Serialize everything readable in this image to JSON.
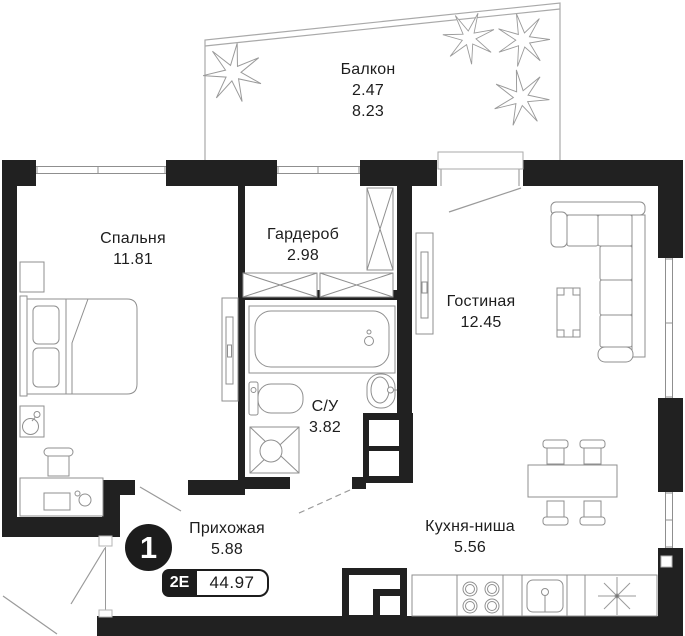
{
  "plan": {
    "badge": {
      "number": "1",
      "layout": "2Е",
      "total_area": "44.97"
    },
    "rooms": {
      "balcony": {
        "name": "Балкон",
        "area": "2.47",
        "area_full": "8.23"
      },
      "bedroom": {
        "name": "Спальня",
        "area": "11.81"
      },
      "wardrobe": {
        "name": "Гардероб",
        "area": "2.98"
      },
      "living": {
        "name": "Гостиная",
        "area": "12.45"
      },
      "bathroom": {
        "name": "С/У",
        "area": "3.82"
      },
      "hallway": {
        "name": "Прихожая",
        "area": "5.88"
      },
      "kitchen": {
        "name": "Кухня-ниша",
        "area": "5.56"
      }
    },
    "colors": {
      "wall": "#212121",
      "furniture_line": "#8f8f8f",
      "text": "#1d1d1d",
      "badge_bg": "#1c1c1c"
    }
  }
}
